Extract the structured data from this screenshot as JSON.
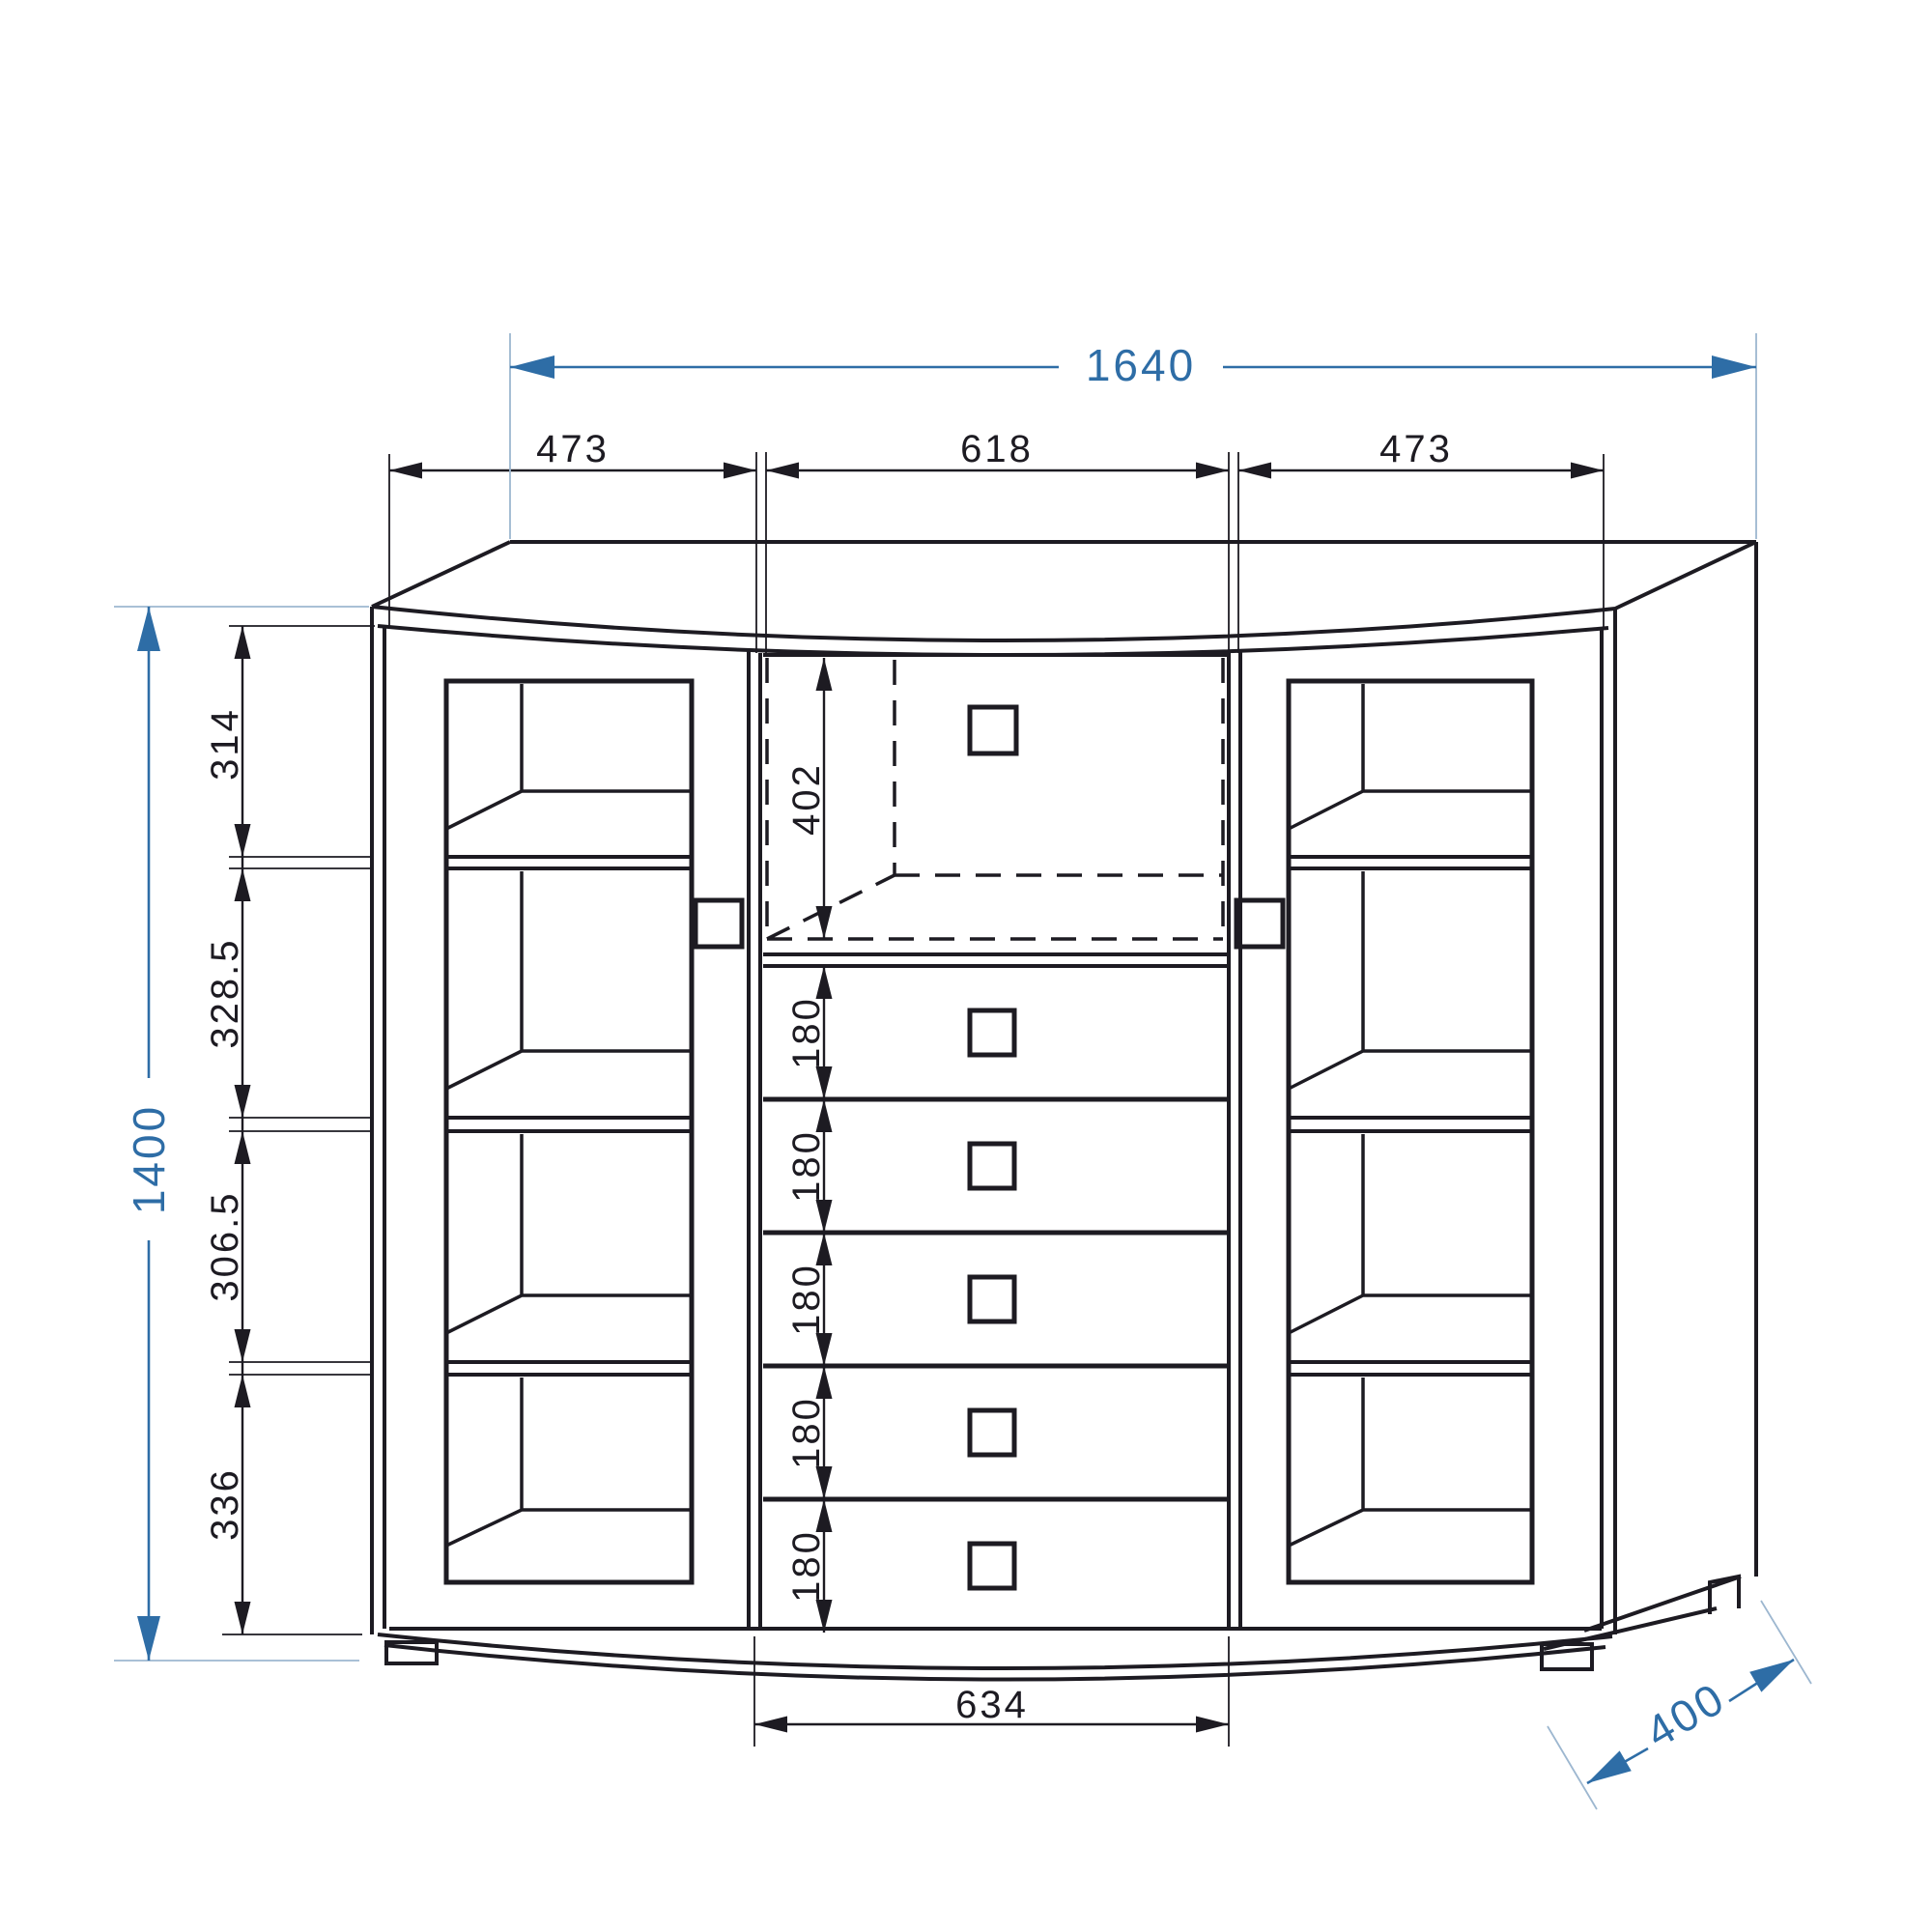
{
  "drawing": {
    "type": "furniture-dimension-diagram",
    "units": "mm"
  },
  "colors": {
    "background": "#ffffff",
    "line": "#1d1b22",
    "dimension_accent": "#2e6da6",
    "extension_light": "#9db7d0"
  },
  "dimensions": {
    "overall_width": "1640",
    "overall_height": "1400",
    "depth": "400",
    "top_sections": [
      "473",
      "618",
      "473"
    ],
    "left_sections": [
      "314",
      "328.5",
      "306.5",
      "336"
    ],
    "niche_height": "402",
    "drawer_heights": [
      "180",
      "180",
      "180",
      "180",
      "180"
    ],
    "drawers_width": "634"
  }
}
